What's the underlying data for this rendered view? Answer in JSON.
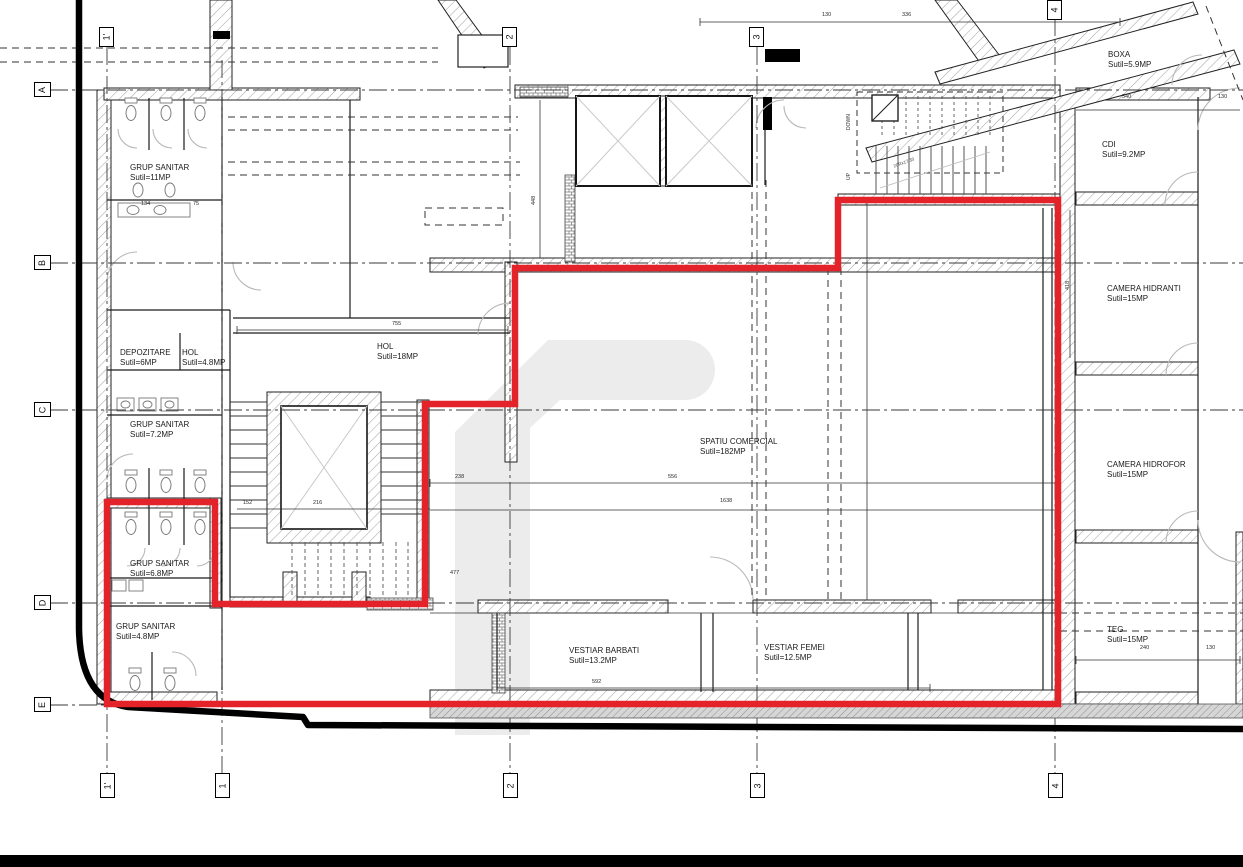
{
  "rooms": [
    {
      "name": "GRUP SANITAR",
      "area": "Sutil=11MP"
    },
    {
      "name": "DEPOZITARE",
      "area": "Sutil=6MP"
    },
    {
      "name": "HOL",
      "area": "Sutil=4.8MP"
    },
    {
      "name": "GRUP SANITAR",
      "area": "Sutil=7.2MP"
    },
    {
      "name": "GRUP SANITAR",
      "area": "Sutil=6.8MP"
    },
    {
      "name": "GRUP SANITAR",
      "area": "Sutil=4.8MP"
    },
    {
      "name": "HOL",
      "area": "Sutil=18MP"
    },
    {
      "name": "SPATIU COMERCIAL",
      "area": "Sutil=182MP"
    },
    {
      "name": "VESTIAR BARBATI",
      "area": "Sutil=13.2MP"
    },
    {
      "name": "VESTIAR FEMEI",
      "area": "Sutil=12.5MP"
    },
    {
      "name": "BOXA",
      "area": "Sutil=5.9MP"
    },
    {
      "name": "CDI",
      "area": "Sutil=9.2MP"
    },
    {
      "name": "CAMERA HIDRANTI",
      "area": "Sutil=15MP"
    },
    {
      "name": "CAMERA HIDROFOR",
      "area": "Sutil=15MP"
    },
    {
      "name": "TEG",
      "area": "Sutil=15MP"
    }
  ],
  "grid": {
    "rows": [
      "A",
      "B",
      "C",
      "D",
      "E"
    ],
    "cols_bottom": [
      "1'",
      "1",
      "2",
      "3",
      "4"
    ],
    "cols_top": [
      "1'",
      "2",
      "3",
      "4"
    ]
  },
  "stair": {
    "up": "UP",
    "down": "DOWN",
    "note": "20Rx17/30"
  },
  "dims": [
    "755",
    "238",
    "556",
    "1638",
    "152",
    "216",
    "477",
    "592",
    "540",
    "130",
    "240",
    "130",
    "336",
    "130",
    "134",
    "75",
    "418",
    "448"
  ],
  "colors": {
    "highlight": "#e4222a",
    "boundary": "#000000",
    "watermark": "#ececec"
  }
}
